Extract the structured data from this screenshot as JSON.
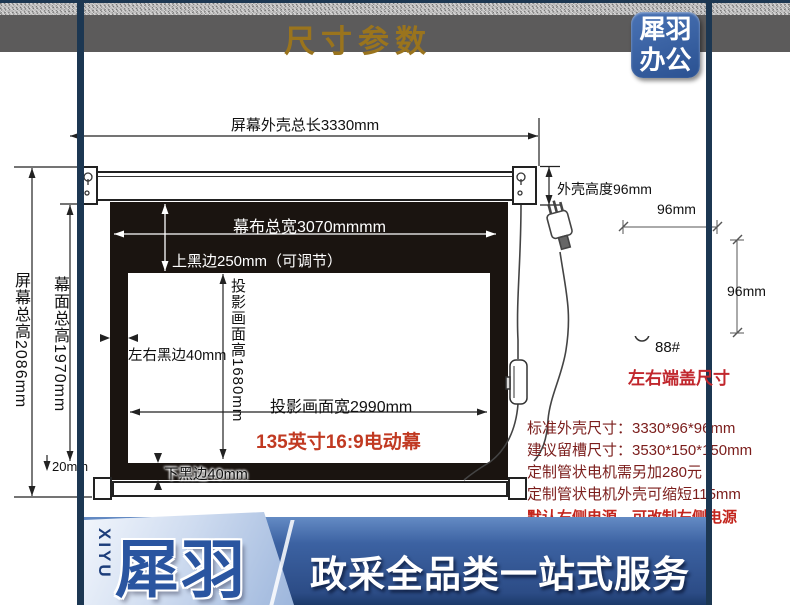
{
  "header": {
    "title": "尺寸参数",
    "logo_line1": "犀羽",
    "logo_line2": "办公"
  },
  "diagram": {
    "dim_total_length": "屏幕外壳总长3330mm",
    "dim_case_height": "外壳高度96mm",
    "dim_fabric_width": "幕布总宽3070mmmm",
    "dim_top_black": "上黑边250mm（可调节）",
    "dim_screen_total_height": "屏幕总高2086mm",
    "dim_fabric_height": "幕面总高1970mm",
    "dim_side_black": "左右黑边40mm",
    "dim_view_height": "投影画面高1680mm",
    "dim_view_width": "投影画面宽2990mm",
    "model_label": "135英寸16:9电动幕",
    "dim_bottom_black": "下黑边40mm",
    "dim_bottom_gap": "20mm"
  },
  "endcap": {
    "dim_width": "96mm",
    "dim_height": "96mm",
    "model": "88#",
    "caption": "左右端盖尺寸"
  },
  "specs": {
    "lines": [
      "标准外壳尺寸：3330*96*96mm",
      "建议留槽尺寸：3530*150*150mm",
      "定制管状电机需另加280元",
      "定制管状电机外壳可缩短115mm"
    ],
    "highlight": "默认右侧电源，可改制左侧电源"
  },
  "footer": {
    "brand_en": "XIYU",
    "brand_cn": "犀羽",
    "slogan": "政采全品类一站式服务"
  },
  "colors": {
    "frame_navy": "#1c3752",
    "header_gray": "#5c5b5b",
    "title_gold": "#9a741d",
    "logo_blue": "#2a5191",
    "screen_black": "#1a1410",
    "model_red": "#c13a22",
    "caption_red": "#c1272d",
    "spec_maroon": "#7b1d1b",
    "highlight_red": "#c3251d",
    "banner_blue": "#2c4c86"
  }
}
